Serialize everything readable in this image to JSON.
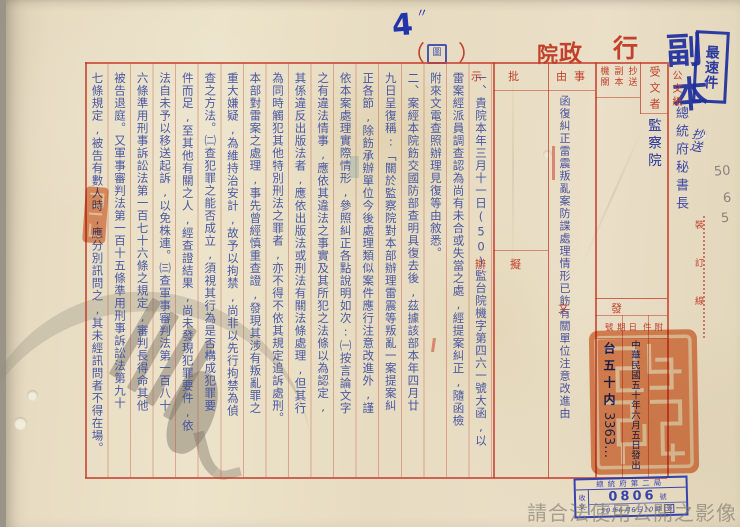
{
  "page": {
    "handwritten_page_number": "4",
    "handwritten_tick": "〃",
    "classification_parens": {
      "open": "（",
      "close": "）"
    },
    "classification_mark": "圖"
  },
  "header": {
    "title_chars": [
      "行",
      "政",
      "院"
    ],
    "paper_label": "公文紙"
  },
  "stamps": {
    "copy_stamp_chars": [
      "副",
      "本"
    ],
    "priority_stamp": "最速件",
    "recipient_cc": "總統府秘書長",
    "cc_annotation": "抄送",
    "binding_line": "裝訂線",
    "pencil_note": [
      "50",
      "6",
      "5"
    ],
    "seal": "行政院印",
    "receipt": {
      "agency": "總統府第二局",
      "doc_type": "收文",
      "number": "0806",
      "number_suffix": "號",
      "datetime": "50年6月6日10時",
      "sign": "簽"
    }
  },
  "form": {
    "recipient_label": "受文者",
    "recipient_value": "監察院",
    "cc_box_labels": [
      "抄送",
      "副本",
      "機關"
    ],
    "subject_label": "事由",
    "subject_value": "函復糾正雷震叛亂案防諜處理情形已飭有關單位注意改進由",
    "approval_label": "批示",
    "draft_label": "擬辦",
    "dispatch": {
      "section_label": "發文",
      "number_label": "號",
      "date_label": "日期",
      "attachment_label": "附件",
      "number_value": "台五十内",
      "number_handwritten": "3363…",
      "date_value": "中華民國五十年六月五日發出"
    }
  },
  "body": {
    "columns": [
      "一、貴院本年三月十一日(50)監台院機字第四六一號大函,以",
      "雷案經派員調查認為尚有未合或失當之處,經提案糾正,隨函檢",
      "附來文電查照辦理見復等由敘悉。",
      "二、案經本院飭交國防部查明具復去後,茲據該部本年四月廿",
      "九日呈復稱:「關於監察院對本部辦理雷震等叛亂一案提案糾",
      "正各節,除飭承辦單位今後處理類似案件應行注意改進外,謹",
      "依本案處理實際情形,參照糾正各點說明如次:㈠按言論文字",
      "之有違法情事,應依其違法之事實及其所犯之法條以為認定,",
      "其係違反出版法者,應依出版法或刑法有關法條處理,但其行",
      "為同時觸犯其他特別刑法之罪者,亦不得不依其規定追訴處刑。",
      "本部對雷案之處理,事先曾經慎重查證,發現其涉有叛亂罪之",
      "重大嫌疑,為維持治安計,故予以拘禁,尚非以先行拘禁為偵",
      "查之方法。㈡查犯罪之能否成立,須視其行為是否構成犯罪要",
      "件而足,至其他有關之人,經查證結果,尚未發現犯罪要件,依",
      "法自未予以移送起訴,以免株連。㈢查軍事審判法第一百八十",
      "六條準用刑事訴訟法第一百七十六條之規定,審判長得命其他",
      "被告退庭。又軍事審判法第一百十五條準用刑事訴訟法第九十",
      "七條規定,被告有數人時,應分別訊問之,其未經訊問者不得在場。"
    ]
  },
  "watermark": {
    "notice": "請合法使用公開之影像"
  }
}
